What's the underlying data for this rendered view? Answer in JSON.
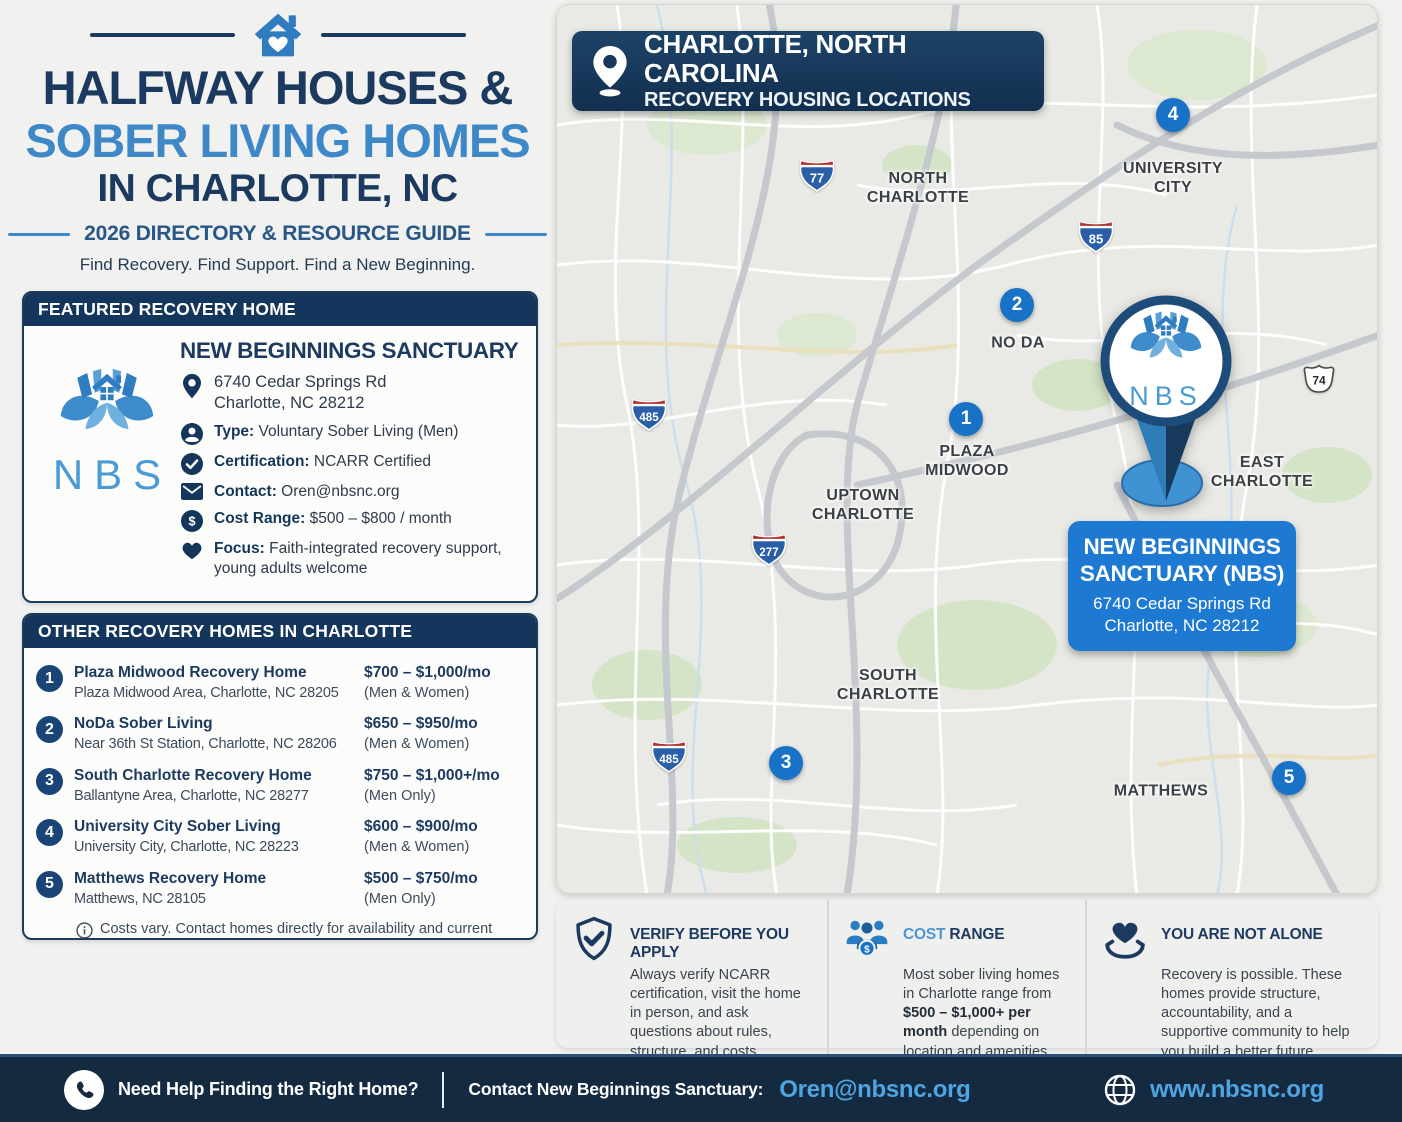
{
  "colors": {
    "navy": "#1c3a5f",
    "navy_dark": "#14365c",
    "title_blue": "#3e88c8",
    "marker_blue": "#1872c8",
    "callout_blue": "#1d79d2",
    "link_blue": "#4fa4e2",
    "footer_bg": "#142a40"
  },
  "header": {
    "title_line1": "HALFWAY HOUSES &",
    "title_line2": "SOBER LIVING HOMES",
    "title_line3": "IN CHARLOTTE, NC",
    "subtitle": "2026 DIRECTORY & RESOURCE GUIDE",
    "tagline": "Find Recovery. Find Support. Find a New Beginning."
  },
  "featured": {
    "section_label": "FEATURED RECOVERY HOME",
    "name": "NEW BEGINNINGS SANCTUARY",
    "logo_text": "NBS",
    "address_line1": "6740 Cedar Springs Rd",
    "address_line2": "Charlotte, NC 28212",
    "fields": [
      {
        "label": "Type:",
        "value": "Voluntary Sober Living (Men)"
      },
      {
        "label": "Certification:",
        "value": "NCARR Certified"
      },
      {
        "label": "Contact:",
        "value": "Oren@nbsnc.org"
      },
      {
        "label": "Cost Range:",
        "value": "$500 – $800 / month"
      },
      {
        "label": "Focus:",
        "value": "Faith-integrated recovery support, young adults welcome"
      }
    ]
  },
  "other_homes": {
    "section_label": "OTHER RECOVERY HOMES IN CHARLOTTE",
    "items": [
      {
        "number": "1",
        "name": "Plaza Midwood Recovery Home",
        "location": "Plaza Midwood Area, Charlotte, NC 28205",
        "price": "$700 – $1,000/mo",
        "occupancy": "(Men & Women)"
      },
      {
        "number": "2",
        "name": "NoDa Sober Living",
        "location": "Near 36th St Station, Charlotte, NC 28206",
        "price": "$650 – $950/mo",
        "occupancy": "(Men & Women)"
      },
      {
        "number": "3",
        "name": "South Charlotte Recovery Home",
        "location": "Ballantyne Area, Charlotte, NC 28277",
        "price": "$750 – $1,000+/mo",
        "occupancy": "(Men Only)"
      },
      {
        "number": "4",
        "name": "University City Sober Living",
        "location": "University City, Charlotte, NC 28223",
        "price": "$600 – $900/mo",
        "occupancy": "(Men & Women)"
      },
      {
        "number": "5",
        "name": "Matthews Recovery Home",
        "location": "Matthews, NC 28105",
        "price": "$500 – $750/mo",
        "occupancy": "(Men Only)"
      }
    ],
    "footnote": "Costs vary. Contact homes directly for availability and current rates."
  },
  "map": {
    "badge_title": "CHARLOTTE, NORTH CAROLINA",
    "badge_subtitle": "RECOVERY HOUSING LOCATIONS",
    "area_labels": [
      {
        "lines": [
          "NORTH",
          "CHARLOTTE"
        ]
      },
      {
        "lines": [
          "UNIVERSITY",
          "CITY"
        ]
      },
      {
        "lines": [
          "NO DA"
        ]
      },
      {
        "lines": [
          "PLAZA",
          "MIDWOOD"
        ]
      },
      {
        "lines": [
          "UPTOWN",
          "CHARLOTTE"
        ]
      },
      {
        "lines": [
          "EAST",
          "CHARLOTTE"
        ]
      },
      {
        "lines": [
          "SOUTH",
          "CHARLOTTE"
        ]
      },
      {
        "lines": [
          "MATTHEWS"
        ]
      }
    ],
    "shields": [
      {
        "number": "77"
      },
      {
        "number": "85"
      },
      {
        "number": "485"
      },
      {
        "number": "277"
      },
      {
        "number": "485"
      },
      {
        "number": "74"
      }
    ],
    "markers": [
      {
        "number": "1"
      },
      {
        "number": "2"
      },
      {
        "number": "3"
      },
      {
        "number": "4"
      },
      {
        "number": "5"
      }
    ],
    "pin_logo_text": "NBS",
    "callout": {
      "title_line1": "NEW BEGINNINGS",
      "title_line2": "SANCTUARY (NBS)",
      "address_line1": "6740 Cedar Springs Rd",
      "address_line2": "Charlotte, NC 28212"
    }
  },
  "info_boxes": {
    "verify": {
      "title": "VERIFY BEFORE YOU APPLY",
      "body": "Always verify NCARR certification, visit the home in person, and ask questions about rules, structure, and costs."
    },
    "cost": {
      "title_part1": "COST",
      "title_part2": " RANGE",
      "body_pre": "Most sober living homes in Charlotte range from ",
      "body_bold": "$500 – $1,000+ per month",
      "body_post": " depending on location and amenities."
    },
    "alone": {
      "title": "YOU ARE NOT ALONE",
      "body": "Recovery is possible. These homes provide structure, accountability, and a supportive community to help you build a better future."
    }
  },
  "footer": {
    "help_text": "Need Help Finding the Right Home?",
    "contact_label": "Contact New Beginnings Sanctuary:",
    "email": "Oren@nbsnc.org",
    "website": "www.nbsnc.org"
  }
}
